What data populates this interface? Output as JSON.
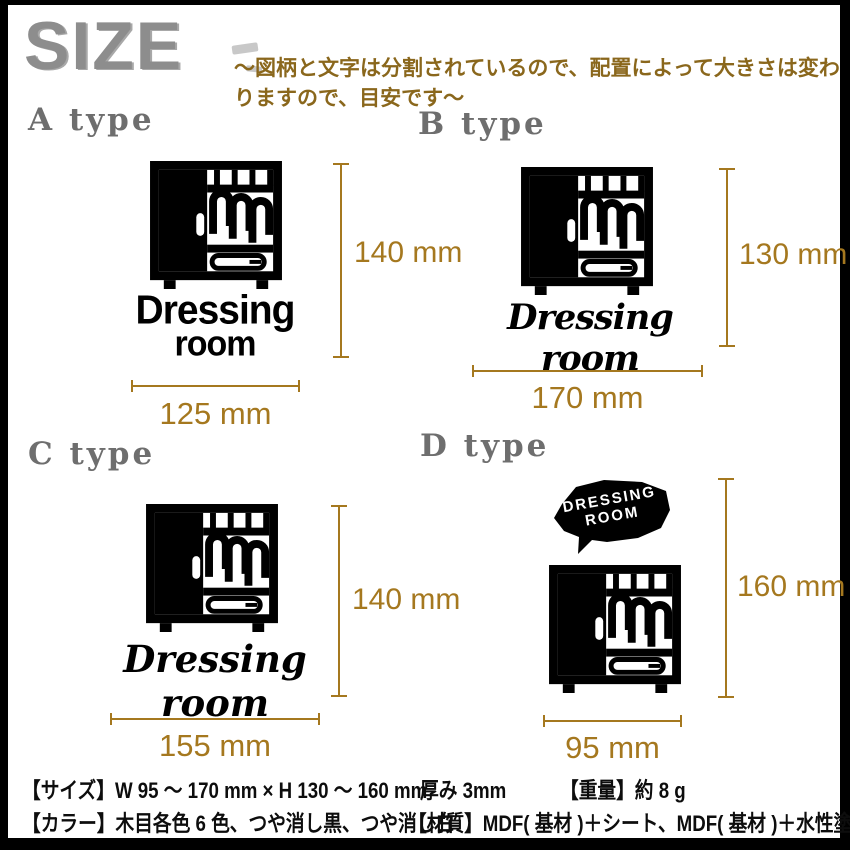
{
  "header": {
    "logo": "SIZE",
    "note": "～図柄と文字は分割されているので、配置によって大きさは変わりますので、目安です～"
  },
  "types": [
    {
      "label": "A type",
      "height": "140 mm",
      "width": "125 mm",
      "sign_line1": "Dressing",
      "sign_line2": "room"
    },
    {
      "label": "B type",
      "height": "130 mm",
      "width": "170 mm",
      "sign_text": "Dressing room"
    },
    {
      "label": "C type",
      "height": "140 mm",
      "width": "155 mm",
      "sign_text": "Dressing room"
    },
    {
      "label": "D type",
      "height": "160 mm",
      "width": "95 mm",
      "bubble_line1": "DRESSING",
      "bubble_line2": "ROOM"
    }
  ],
  "specs": {
    "size": "【サイズ】W 95 ～ 170 mm × H 130 ～ 160 mm",
    "thickness": "厚み 3mm",
    "weight": "【重量】約 8 g",
    "color": "【カラー】木目各色 6 色、つや消し黒、つや消し白",
    "material": "【材質】MDF( 基材 )＋シート、MDF( 基材 )＋水性塗料"
  },
  "colors": {
    "dimension_gold": "#a5781f",
    "note_brown": "#8a671c",
    "type_label_gray": "#6e6e6e",
    "logo_gray": "#8d8d8d",
    "artwork_black": "#000000",
    "background": "#ffffff",
    "frame_black": "#000000"
  }
}
